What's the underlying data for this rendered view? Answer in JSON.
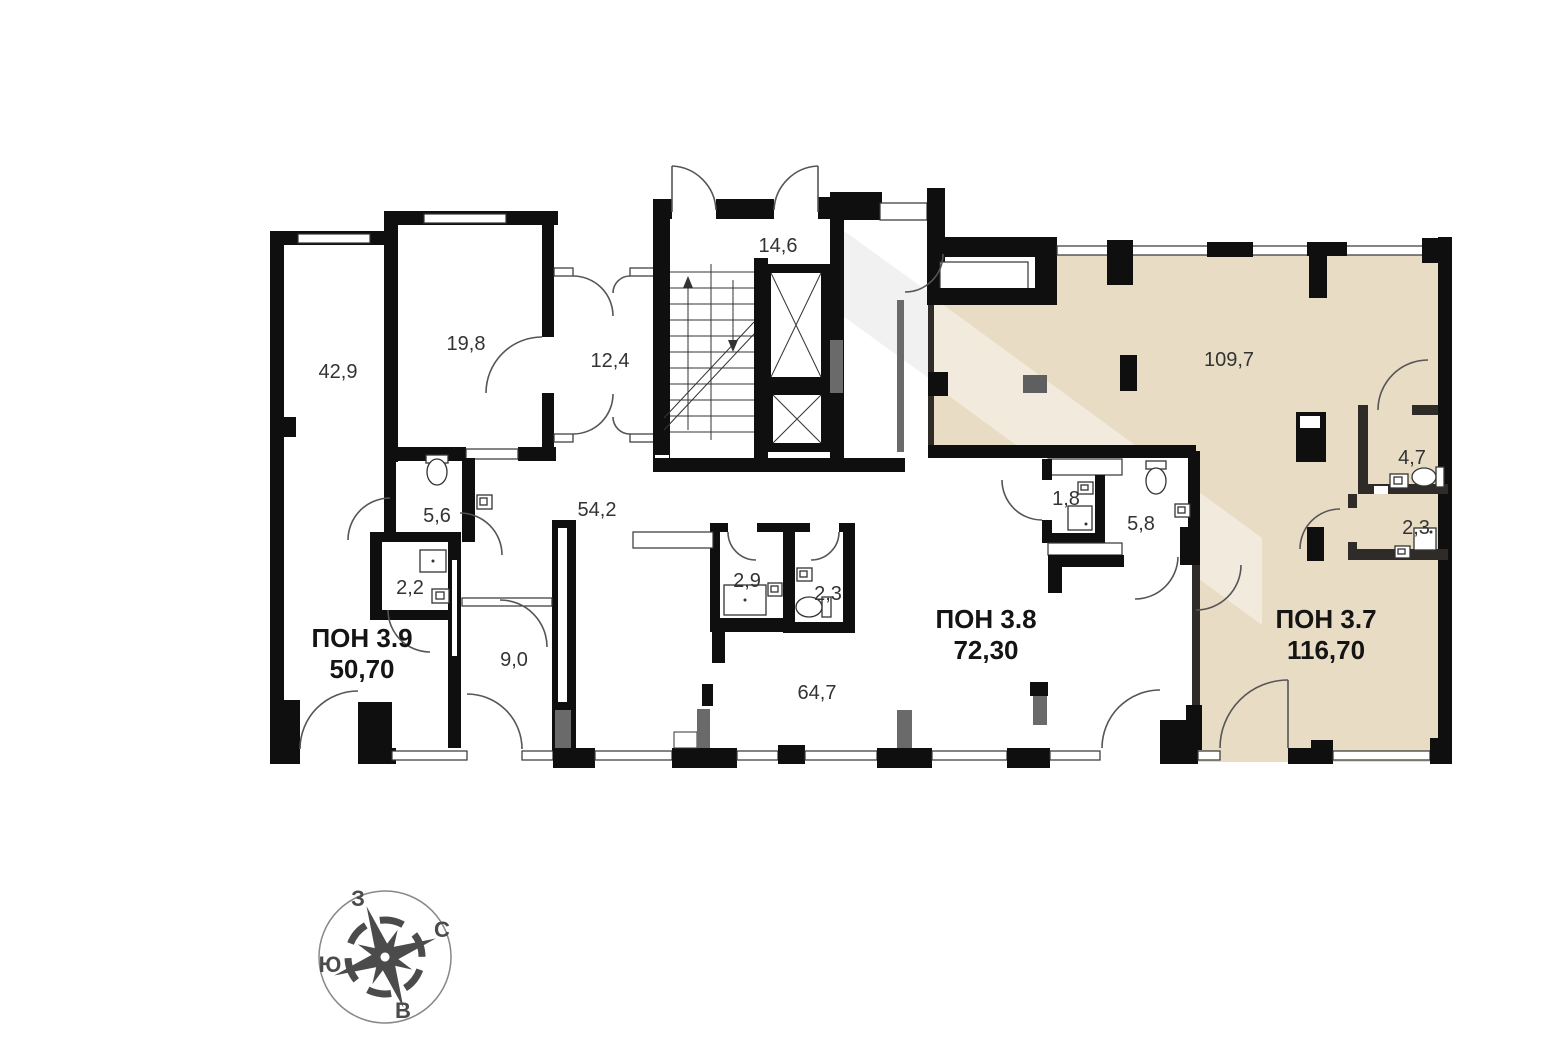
{
  "floor_plan": {
    "units": [
      {
        "id": "3.9",
        "label": "ПОН 3.9",
        "area": "50,70",
        "highlighted": false
      },
      {
        "id": "3.8",
        "label": "ПОН 3.8",
        "area": "72,30",
        "highlighted": false
      },
      {
        "id": "3.7",
        "label": "ПОН 3.7",
        "area": "116,70",
        "highlighted": true
      }
    ],
    "room_areas": [
      "42,9",
      "19,8",
      "12,4",
      "14,6",
      "5,6",
      "54,2",
      "2,2",
      "9,0",
      "2,9",
      "2,3",
      "64,7",
      "1,8",
      "5,8",
      "109,7",
      "4,7",
      "2,3"
    ],
    "compass": {
      "west": "З",
      "north": "С",
      "south": "Ю",
      "east": "В"
    },
    "colors": {
      "wall": "#0f0f0f",
      "unit_highlight": "#e8dcc4",
      "door_arc": "#555555",
      "compass": "#4b4b4b"
    }
  }
}
